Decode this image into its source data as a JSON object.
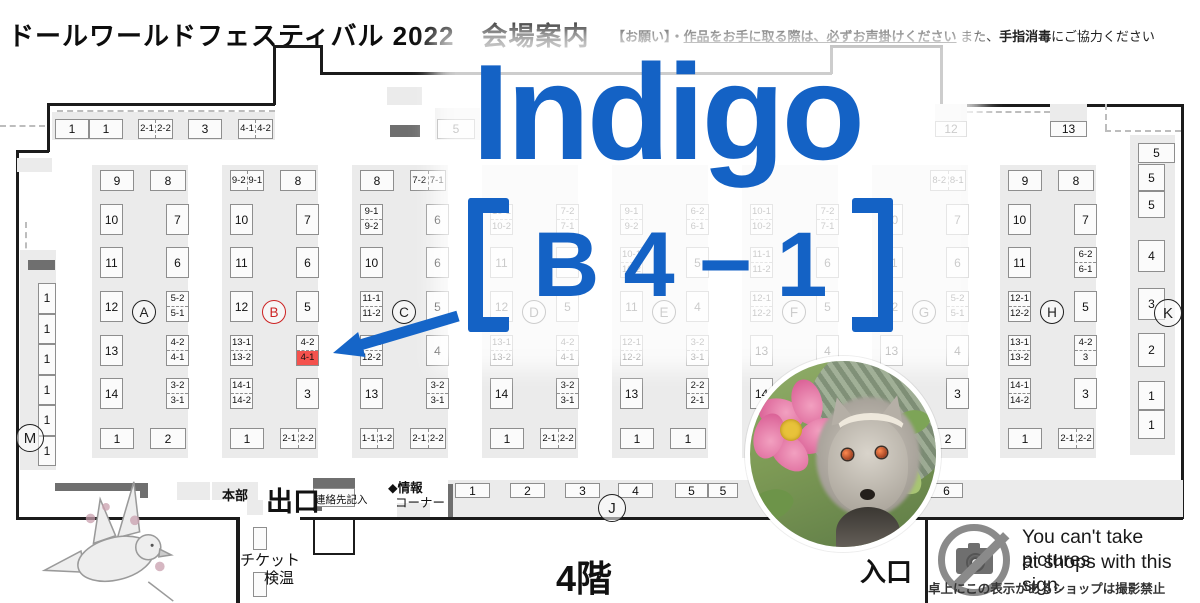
{
  "header": {
    "title": "ドールワールドフェスティバル 2022　会場案内",
    "notice_seg1": "【お願い】・",
    "notice_seg2": "作品をお手に取る際は、必ずお声掛けください",
    "notice_seg3": " また、",
    "notice_seg4": "手指消毒",
    "notice_seg5": "にご協力ください"
  },
  "overlay": {
    "line1": "Indigo",
    "line2": "【Ｂ４－１】",
    "line2_chars": [
      "B",
      "4",
      "−",
      "1"
    ],
    "accent_blue": "#1462c5",
    "highlight_booth": "4-1",
    "highlight_block": "B",
    "highlight_red": "#f4524d"
  },
  "map": {
    "floor_label": "4階",
    "exit_label": "出口",
    "entrance_label": "入口",
    "hq_label": "本部",
    "contact_label": "連絡先記入",
    "info_corner_line1": "◆情報",
    "info_corner_line2": "コーナー",
    "ticket_line1": "チケット",
    "ticket_line2": "検温",
    "top_row": [
      "1",
      "1",
      [
        "2-1",
        "2-2"
      ],
      "3",
      [
        "4-1",
        "4-2"
      ],
      "5"
    ],
    "wall_booths": [
      "12",
      "13"
    ],
    "blocks": [
      {
        "label": "A",
        "red": false,
        "header": [
          "9",
          "8"
        ],
        "left": [
          "10",
          "11",
          "12",
          "13",
          "14"
        ],
        "right": [
          "7",
          "6",
          [
            "5-2",
            "5-1"
          ],
          [
            "4-2",
            "4-1"
          ],
          [
            "3-2",
            "3-1"
          ]
        ],
        "bottom": [
          "1",
          "2"
        ]
      },
      {
        "label": "B",
        "red": true,
        "header": [
          [
            "9-2",
            "9-1"
          ],
          "8"
        ],
        "left": [
          "10",
          "11",
          "12",
          [
            "13-1",
            "13-2"
          ],
          [
            "14-1",
            "14-2"
          ]
        ],
        "right": [
          "7",
          "6",
          "5",
          {
            "pair": [
              "4-2",
              "4-1"
            ],
            "hi": 1
          },
          "3"
        ],
        "bottom": [
          "1",
          [
            "2-1",
            "2-2"
          ]
        ]
      },
      {
        "label": "C",
        "red": false,
        "header": [
          "8",
          [
            "7-2",
            "7-1"
          ]
        ],
        "left": [
          [
            "9-1",
            "9-2"
          ],
          "10",
          [
            "11-1",
            "11-2"
          ],
          [
            "12-1",
            "12-2"
          ],
          "13"
        ],
        "right": [
          "6",
          "6",
          "5",
          "4",
          [
            "3-2",
            "3-1"
          ]
        ],
        "bottom": [
          [
            "1-1",
            "1-2"
          ],
          [
            "2-1",
            "2-2"
          ]
        ]
      },
      {
        "label": "D",
        "red": false,
        "header": [
          null,
          null
        ],
        "left": [
          [
            "10-1",
            "10-2"
          ],
          "11",
          "12",
          [
            "13-1",
            "13-2"
          ],
          "14"
        ],
        "right": [
          [
            "7-2",
            "7-1"
          ],
          "6",
          "5",
          [
            "4-2",
            "4-1"
          ],
          [
            "3-2",
            "3-1"
          ]
        ],
        "bottom": [
          "1",
          [
            "2-1",
            "2-2"
          ]
        ]
      },
      {
        "label": "E",
        "red": false,
        "header": [
          null,
          null
        ],
        "left": [
          [
            "9-1",
            "9-2"
          ],
          [
            "10-1",
            "10-2"
          ],
          "11",
          [
            "12-1",
            "12-2"
          ],
          "13"
        ],
        "right": [
          [
            "6-2",
            "6-1"
          ],
          "5",
          "4",
          [
            "3-2",
            "3-1"
          ],
          [
            "2-2",
            "2-1"
          ]
        ],
        "bottom": [
          "1",
          "1"
        ]
      },
      {
        "label": "F",
        "red": false,
        "header": [
          null,
          null
        ],
        "left": [
          [
            "10-1",
            "10-2"
          ],
          [
            "11-1",
            "11-2"
          ],
          [
            "12-1",
            "12-2"
          ],
          "13",
          "14"
        ],
        "right": [
          [
            "7-2",
            "7-1"
          ],
          "6",
          "5",
          "4",
          "3"
        ],
        "bottom": [
          "1",
          "2"
        ]
      },
      {
        "label": "G",
        "red": false,
        "header": [
          null,
          [
            "8-2",
            "8-1"
          ]
        ],
        "left": [
          "10",
          "11",
          "12",
          "13",
          "14"
        ],
        "right": [
          "7",
          "6",
          [
            "5-2",
            "5-1"
          ],
          "4",
          "3"
        ],
        "bottom": [
          "1",
          "2"
        ]
      },
      {
        "label": "H",
        "red": false,
        "header": [
          "9",
          "8"
        ],
        "left": [
          "10",
          "11",
          [
            "12-1",
            "12-2"
          ],
          [
            "13-1",
            "13-2"
          ],
          [
            "14-1",
            "14-2"
          ]
        ],
        "right": [
          "7",
          [
            "6-2",
            "6-1"
          ],
          "5",
          [
            "4-2",
            "3"
          ],
          "3"
        ],
        "bottom": [
          "1",
          [
            "2-1",
            "2-2"
          ]
        ]
      }
    ],
    "m_column": {
      "label": "M",
      "cells": [
        "1",
        "1",
        "1",
        "1",
        "1",
        "1"
      ]
    },
    "k_column": {
      "label": "K",
      "top_booth": "5",
      "groups": [
        [
          "5",
          "5"
        ],
        [
          "4"
        ],
        [
          "3"
        ],
        [
          "2"
        ],
        [
          "1",
          "1"
        ]
      ]
    },
    "j_row": {
      "label": "J",
      "cells": [
        "1",
        "2",
        "3",
        "4",
        "5",
        "5",
        "6"
      ]
    }
  },
  "photo_notice": {
    "line1": "You can't take pictures",
    "line2": "at shops with this sign.",
    "caption": "卓上にこの表示があるショップは撮影禁止",
    "icon": "no-camera-icon"
  }
}
